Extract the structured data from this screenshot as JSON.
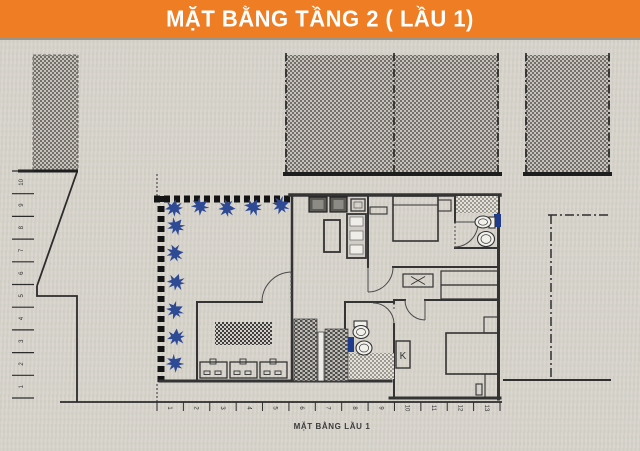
{
  "header": {
    "title": "MẶT BẰNG TẦNG 2 ( LẦU 1)"
  },
  "caption": "MẶT BẰNG LẦU 1",
  "labels": {
    "cabinet_k": "K"
  },
  "dimensions": {
    "left_ticks": [
      "10",
      "9",
      "8",
      "7",
      "6",
      "5",
      "4",
      "3",
      "2",
      "1"
    ],
    "bottom_ticks": [
      "1",
      "2",
      "3",
      "4",
      "5",
      "6",
      "7",
      "8",
      "9",
      "10",
      "11",
      "12",
      "13"
    ]
  },
  "colors": {
    "banner_orange": "#ee7d23",
    "paper": "#d8d4cc",
    "line": "#3a3a3a",
    "plant_blue": "#2e4a95",
    "marker_blue": "#1f3c8c"
  }
}
